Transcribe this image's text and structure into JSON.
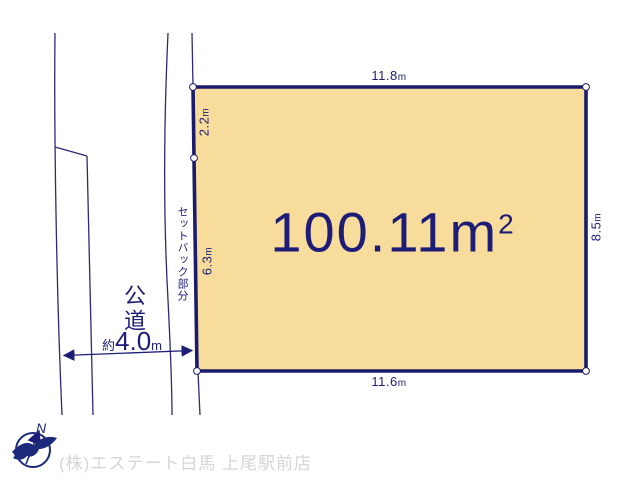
{
  "diagram": {
    "area_label": {
      "value": "100.11",
      "unit": "m",
      "sup": "2"
    },
    "dims": {
      "top": {
        "value": "11.8",
        "unit": "m"
      },
      "bottom": {
        "value": "11.6",
        "unit": "m"
      },
      "right": {
        "value": "8.5",
        "unit": "m"
      },
      "left_upper": {
        "value": "2.2",
        "unit": "m"
      },
      "left_lower": {
        "value": "6.3",
        "unit": "m"
      },
      "road_width": {
        "prefix": "約",
        "value": "4.0",
        "unit": "m"
      }
    },
    "labels": {
      "setback": "セットバック部分",
      "road": "公道",
      "compass_north": "N"
    },
    "footer": {
      "company": "(株)エステート白馬 上尾駅前店"
    },
    "icons": {
      "compass": "compass-north-icon",
      "logo": "bird-logo-icon"
    },
    "colors": {
      "plot_fill": "#f8dc9c",
      "plot_border": "#1b1b6b",
      "thin_line": "#2a2a7a",
      "text": "#1d1d78",
      "footer_text": "#d6d6d6"
    }
  }
}
